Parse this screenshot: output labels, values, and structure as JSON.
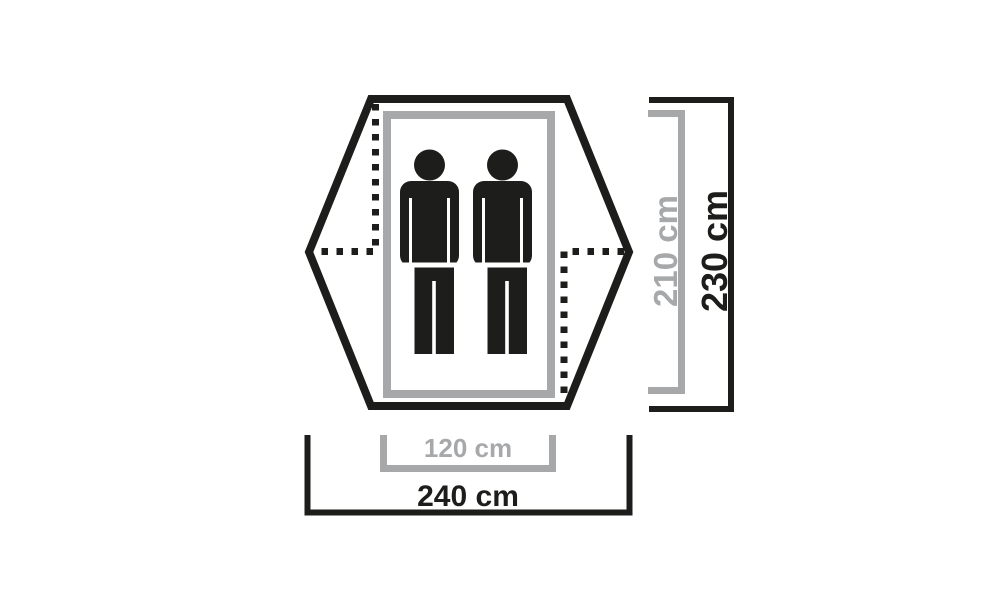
{
  "colors": {
    "ink": "#1d1d1b",
    "gray": "#a6a8aa",
    "background": "#ffffff"
  },
  "diagram": {
    "kind": "tent-floorplan-dimension-diagram",
    "person_icon_count": 2,
    "icons": {
      "person": "person-icon"
    },
    "labels": {
      "inner_width": "120 cm",
      "outer_width": "240 cm",
      "inner_length": "210 cm",
      "outer_length": "230 cm"
    }
  }
}
